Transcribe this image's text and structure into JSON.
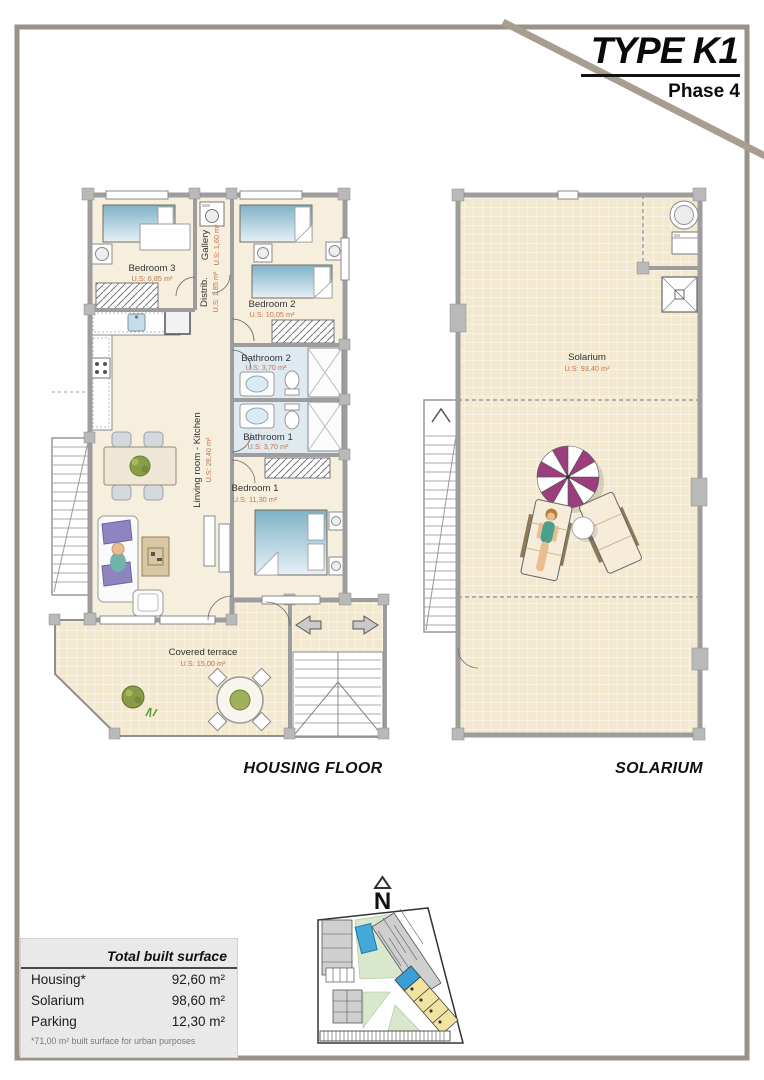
{
  "header": {
    "type_label": "TYPE K1",
    "phase_label": "Phase 4"
  },
  "housing_plan": {
    "caption": "HOUSING FLOOR",
    "rooms": [
      {
        "name": "Bedroom 3",
        "area": "U.S: 6,85 m²"
      },
      {
        "name": "Gallery",
        "area": "U.S: 1,60 m²"
      },
      {
        "name": "Distrib.",
        "area": "U.S: 1,85 m²"
      },
      {
        "name": "Bedroom 2",
        "area": "U.S: 10,05 m²"
      },
      {
        "name": "Bathroom 2",
        "area": "U.S: 3,70 m²"
      },
      {
        "name": "Bathroom 1",
        "area": "U.S: 3,70 m²"
      },
      {
        "name": "Linving room - Kitchen",
        "area": "U.S: 28,40 m²"
      },
      {
        "name": "Bedroom 1",
        "area": "U.S: 11,30 m²"
      },
      {
        "name": "Covered terrace",
        "area": "U.S: 15,00 m²"
      }
    ]
  },
  "solarium_plan": {
    "caption": "SOLARIUM",
    "room": {
      "name": "Solarium",
      "area": "U.S: 93,40 m²"
    }
  },
  "compass": {
    "label": "N"
  },
  "surface_table": {
    "title": "Total built surface",
    "rows": [
      {
        "label": "Housing*",
        "value": "92,60 m²"
      },
      {
        "label": "Solarium",
        "value": "98,60 m²"
      },
      {
        "label": "Parking",
        "value": "12,30 m²"
      }
    ],
    "footnote": "*71,00 m² built surface for urban purposes"
  },
  "colors": {
    "frame": "#9a9188",
    "diagonal": "#a89e90",
    "floor_cream": "#f6efde",
    "bathroom_floor": "#dfe9f0",
    "tile": "#f3e9d0",
    "wall": "#9d9d9d",
    "area_text": "#c3734e",
    "parasol": "#9c3d7d",
    "highlight_unit": "#3a9fd4",
    "yellow_units": "#f2e3a0"
  }
}
